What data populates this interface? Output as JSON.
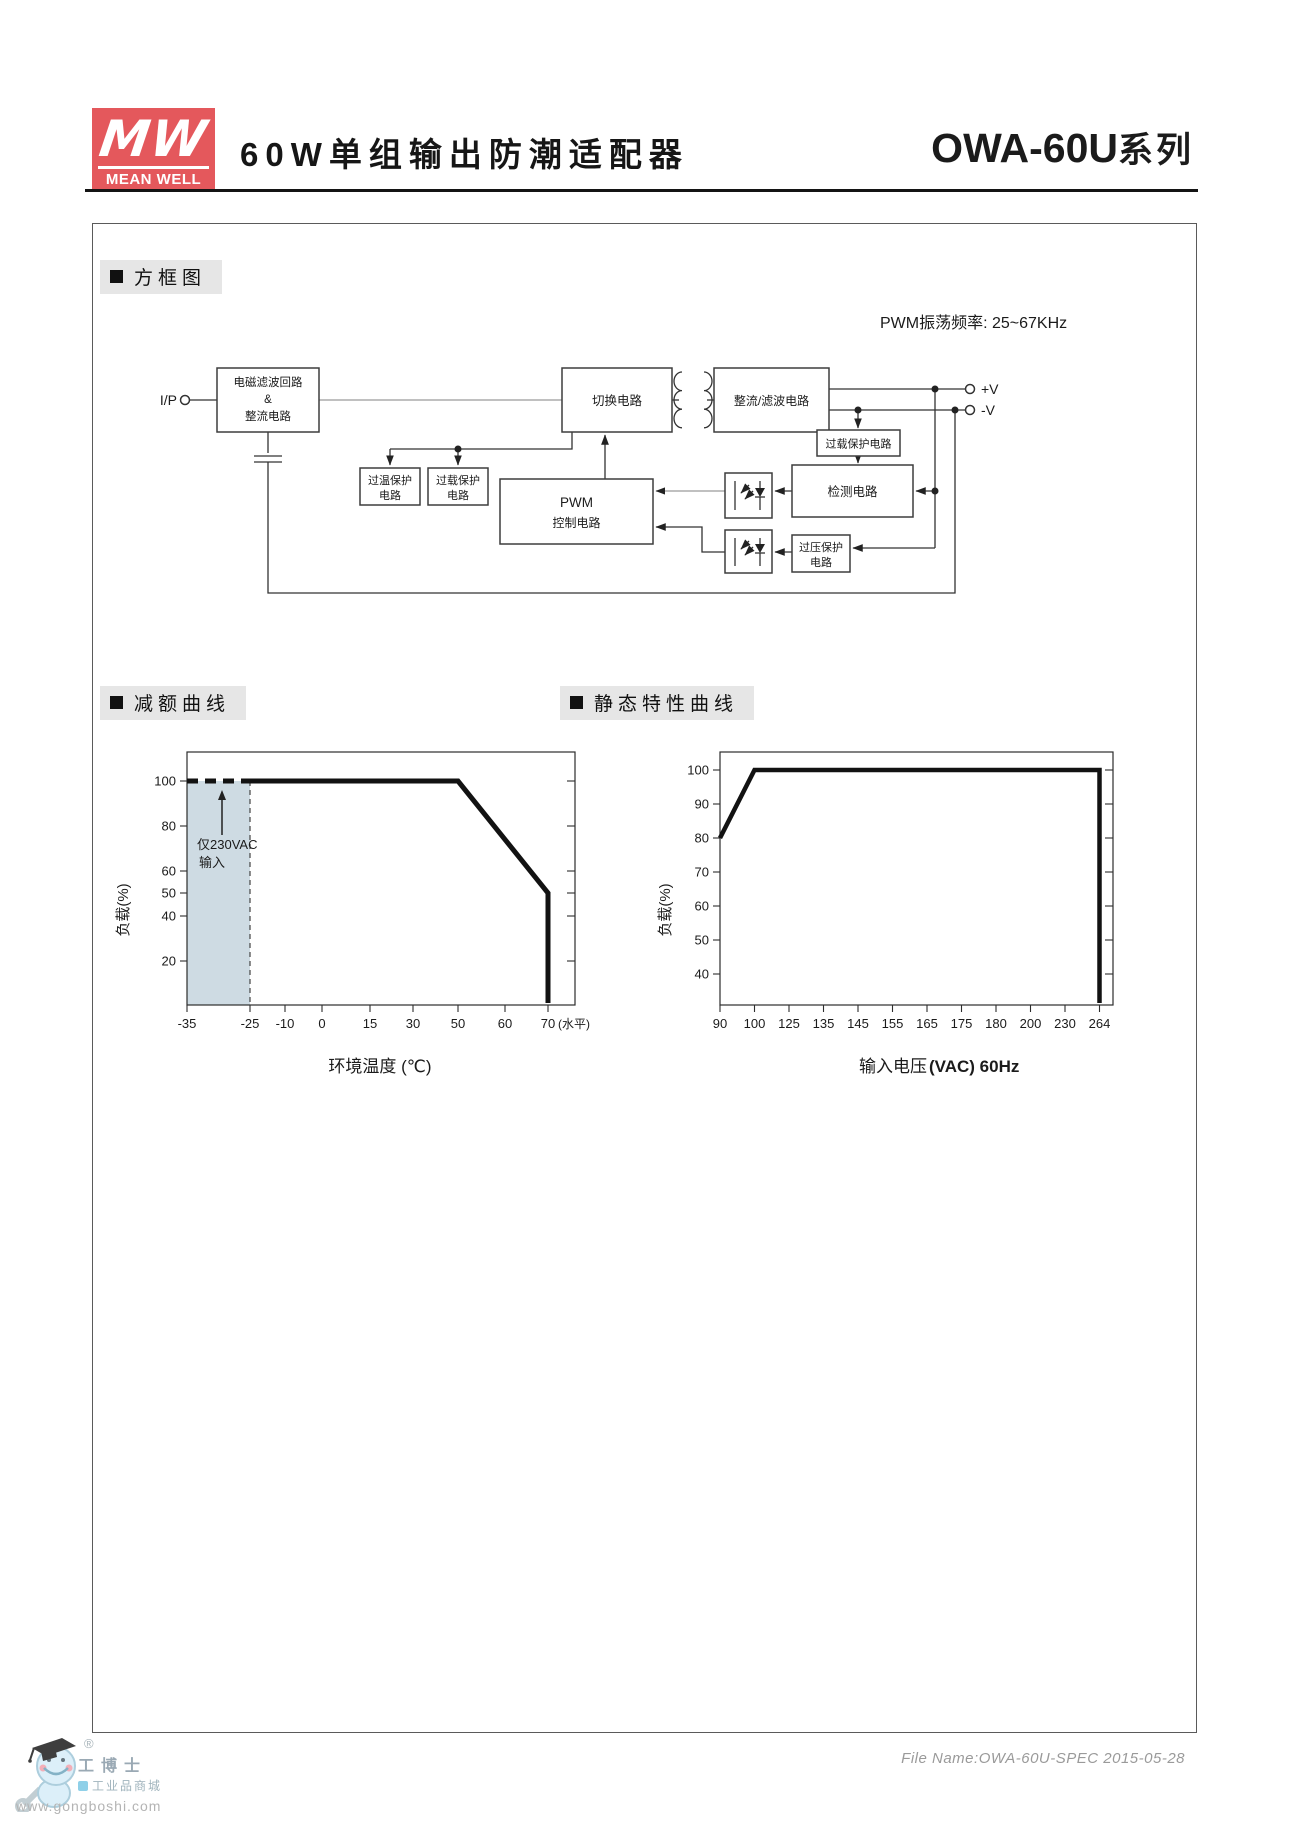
{
  "header": {
    "logo_mw": "MW",
    "logo_name": "MEAN WELL",
    "title": "60W单组输出防潮适配器",
    "series_main": "OWA-60U",
    "series_suffix": "系列"
  },
  "sections": {
    "block_diagram": "方框图",
    "derating": "减额曲线",
    "static_curve": "静态特性曲线"
  },
  "diagram": {
    "pwm_note": "PWM振荡频率: 25~67KHz",
    "ip_label": "I/P",
    "vplus": "+V",
    "vminus": "-V",
    "blocks": {
      "emi1": "电磁滤波回路",
      "emi2": "&",
      "emi3": "整流电路",
      "switching": "切换电路",
      "rectifier": "整流/滤波电路",
      "olp_out": "过载保护电路",
      "detection": "检测电路",
      "pwm1": "PWM",
      "pwm2": "控制电路",
      "otp1": "过温保护",
      "otp2": "电路",
      "olp1": "过载保护",
      "olp2": "电路",
      "ovp1": "过压保护",
      "ovp2": "电路"
    }
  },
  "charts": {
    "derating": {
      "ylabel": "负载(%)",
      "xlabel": "环境温度 (℃)",
      "ann1": "仅230VAC",
      "ann2": "输入",
      "yticks": [
        "100",
        "80",
        "60",
        "50",
        "40",
        "20"
      ],
      "xticks": [
        "-35",
        "-25",
        "-10",
        "0",
        "15",
        "30",
        "50",
        "60",
        "70"
      ],
      "xsuffix": "(水平)"
    },
    "statics": {
      "ylabel": "负载(%)",
      "xlabel_cn": "输入电压",
      "xlabel_en": "(VAC) 60Hz",
      "yticks": [
        "100",
        "90",
        "80",
        "70",
        "60",
        "50",
        "40"
      ],
      "xticks": [
        "90",
        "100",
        "125",
        "135",
        "145",
        "155",
        "165",
        "175",
        "180",
        "200",
        "230",
        "264"
      ]
    }
  },
  "chart_data": [
    {
      "type": "line",
      "title": "减额曲线",
      "xlabel": "环境温度 (℃)",
      "ylabel": "负载(%)",
      "x_ticks": [
        -35,
        -25,
        -10,
        0,
        15,
        30,
        50,
        60,
        70
      ],
      "x_spacing": "categorical",
      "ylim": [
        0,
        110
      ],
      "series": [
        {
          "name": "仅230VAC输入",
          "style": "dashed-bold",
          "x": [
            -35,
            -25
          ],
          "y": [
            100,
            100
          ]
        },
        {
          "name": "负载曲线",
          "style": "solid-bold",
          "x": [
            -25,
            50,
            70,
            70
          ],
          "y": [
            100,
            100,
            50,
            0
          ]
        }
      ],
      "annotations": [
        "仅230VAC 输入 (阴影区 -35~-25℃)",
        "70 (水平)"
      ],
      "shaded_region_x": [
        -35,
        -25
      ]
    },
    {
      "type": "line",
      "title": "静态特性曲线",
      "xlabel": "输入电压(VAC) 60Hz",
      "ylabel": "负载(%)",
      "x_ticks": [
        90,
        100,
        125,
        135,
        145,
        155,
        165,
        175,
        180,
        200,
        230,
        264
      ],
      "x_spacing": "categorical",
      "ylim": [
        30,
        105
      ],
      "series": [
        {
          "name": "负载曲线",
          "style": "solid-bold",
          "x": [
            90,
            100,
            264,
            264
          ],
          "y": [
            80,
            100,
            100,
            0
          ]
        }
      ]
    }
  ],
  "footer": {
    "file_info": "File Name:OWA-60U-SPEC  2015-05-28",
    "watermark": {
      "reg": "®",
      "brand": "工博士",
      "sub": "工业品商城",
      "url": "www.gongboshi.com"
    }
  }
}
